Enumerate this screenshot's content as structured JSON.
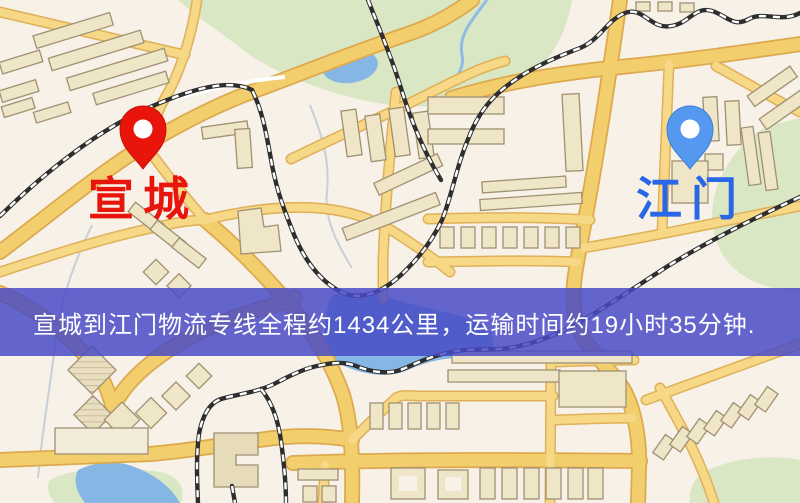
{
  "banner": {
    "text": "宣城到江门物流专线全程约1434公里，运输时间约19小时35分钟.",
    "background_color": "#484ac6",
    "text_color": "#ffffff"
  },
  "map": {
    "origin": {
      "label": "宣城",
      "label_color": "#e8150c",
      "pin_icon": "red-map-pin",
      "pin_color": "#e9150b"
    },
    "destination": {
      "label": "江门",
      "label_color": "#2a67e6",
      "pin_icon": "blue-map-pin",
      "pin_color": "#5598f0"
    },
    "palette": {
      "background": "#f7f1e8",
      "road_fill": "#f3ce6d",
      "road_casing": "#dca94e",
      "park_green": "#d9e7c5",
      "water_blue": "#86b7e4",
      "building_fill": "#efe5c7",
      "building_outline": "#a09073",
      "railway_dark": "#2e2e2e"
    }
  },
  "route": {
    "distance_text": "约1434公里",
    "duration_text": "约19小时35分钟"
  }
}
